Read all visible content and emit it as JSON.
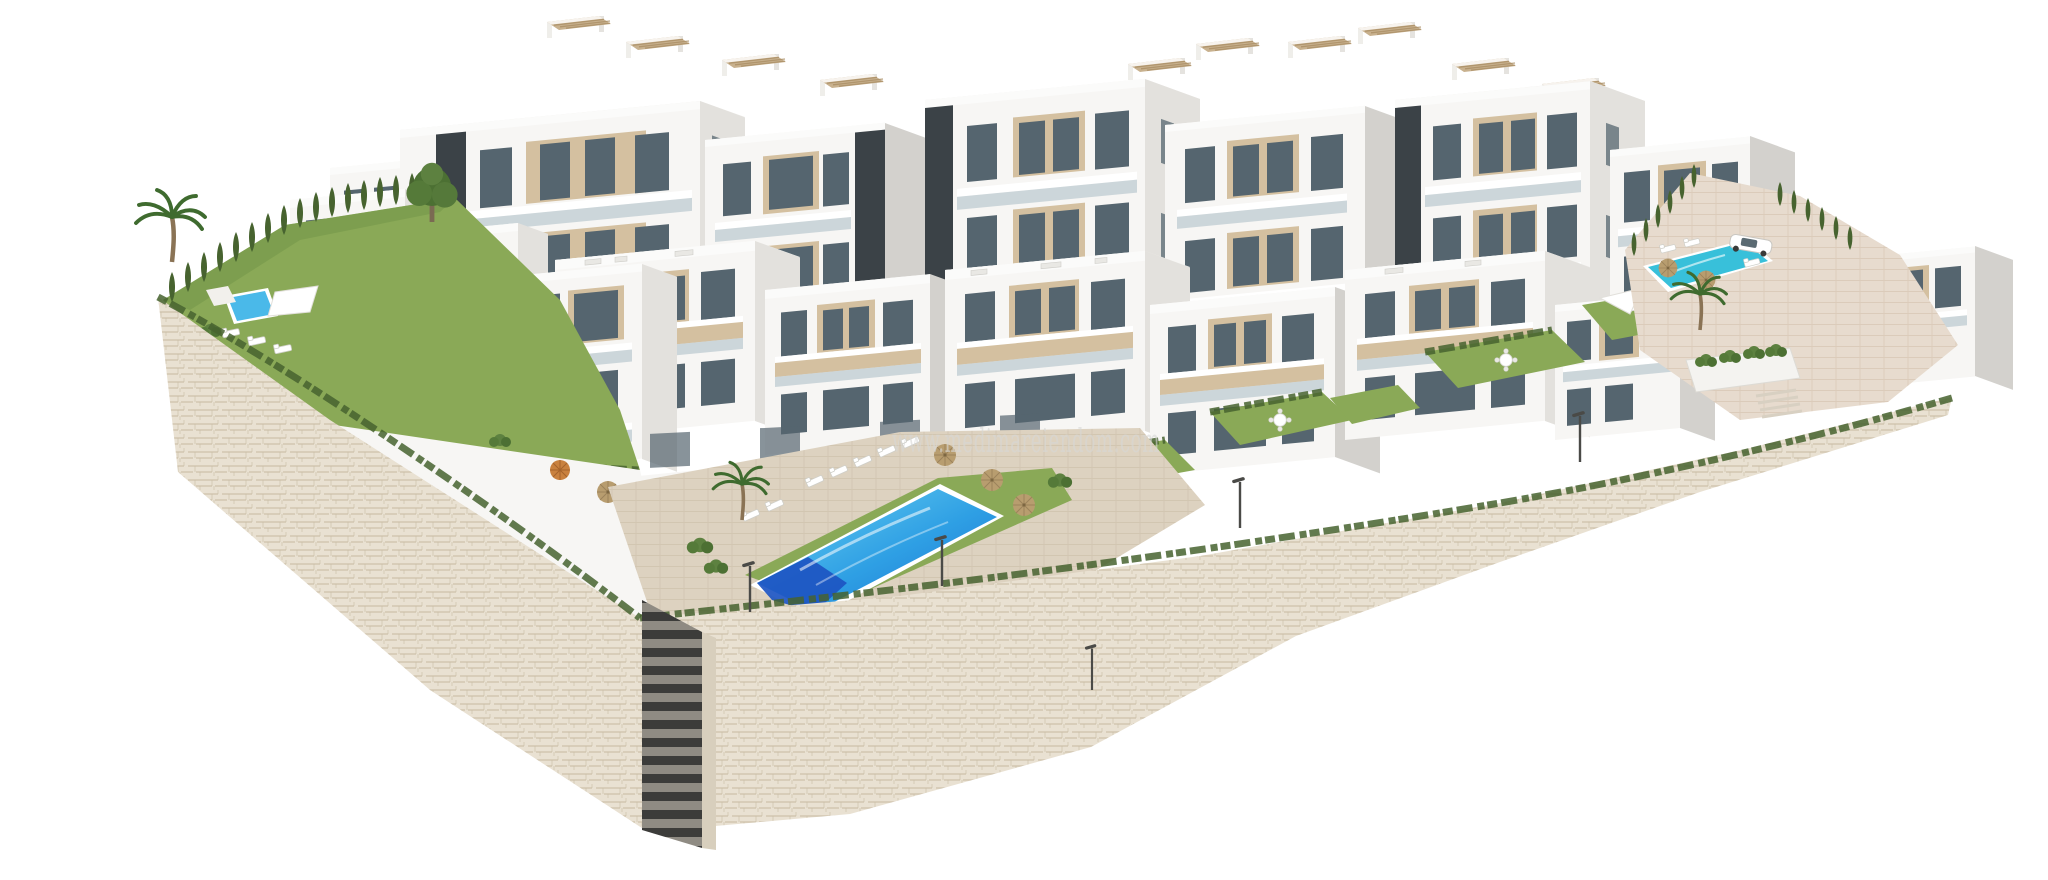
{
  "image": {
    "type": "3d-architectural-render",
    "subject": "Aerial 3D render of a modern white apartment complex on a hillside with terraced gardens, three swimming pools and beige stone retaining walls on a white background"
  },
  "watermark": {
    "text": "www.medimareiendom.com"
  },
  "palette": {
    "background": "#ffffff",
    "building_white": "#f7f6f4",
    "building_shade": "#e3e1dd",
    "building_dark_side": "#d3d1cd",
    "accent_dark": "#3b4247",
    "glass": "#55656f",
    "glass_light": "#a9bcc4",
    "panel_tan": "#d4c0a0",
    "pergola_tan": "#c8b18e",
    "lawn": "#8aa957",
    "lawn_dark": "#74974a",
    "hedge": "#47632f",
    "pool_light": "#4ab9e9",
    "pool_deep": "#1d55c2",
    "pool_right": "#38c0da",
    "stone": "#e9e1d2",
    "stone_joint": "#c8bca4",
    "paver": "#ddd2c0",
    "paver_right": "#e7dbce",
    "parasol_straw": "#b89d6f",
    "parasol_orange": "#c9813f",
    "watermark_color": "#d8d8d6"
  },
  "scene": {
    "features": [
      "white multi-storey apartment blocks with beige accent panels and dark glazing",
      "rooftop pergolas with tan slatted canopies",
      "central main swimming pool with sun loungers and straw parasols",
      "left private garden with small pool, loungers and palm tree",
      "right paved terrace with pool, parasols and parked white car",
      "terraced lawns with outdoor dining sets",
      "beige stone retaining walls with greenery fringe and street lamps",
      "external dark staircase descending the main wall"
    ]
  }
}
